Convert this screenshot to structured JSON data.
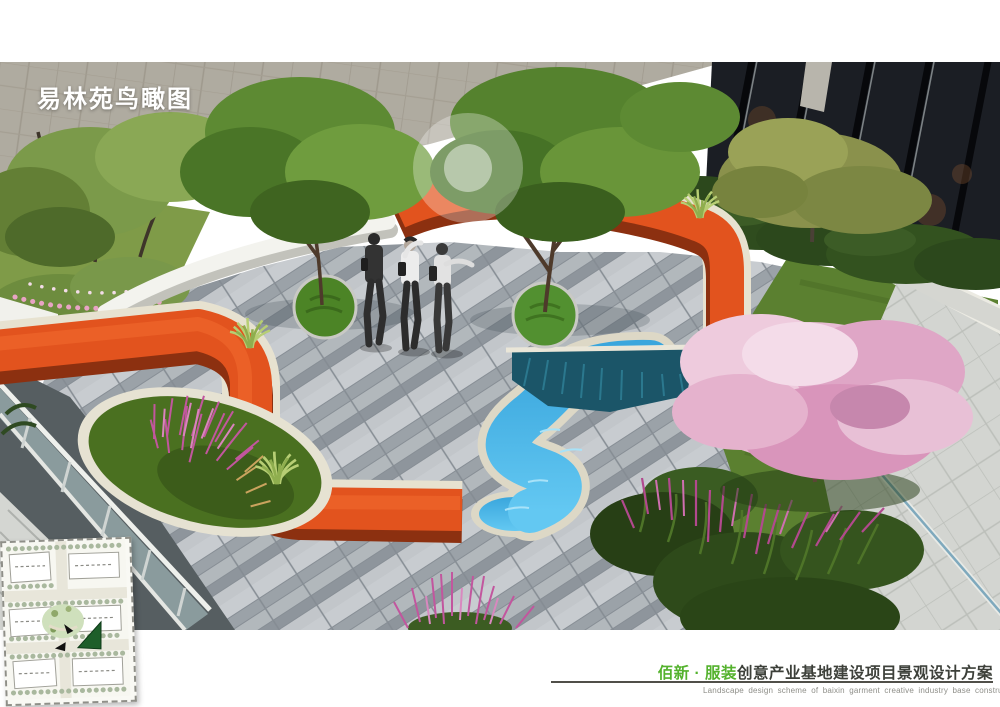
{
  "page": {
    "background_color": "#ffffff",
    "title": "易林苑鸟瞰图",
    "footer": {
      "brand_cn": "佰新 · 服装",
      "project_cn": "创意产业基地建设项目景观设计方案",
      "subtitle_en": "Landscape design scheme of baixin garment creative industry base construction project",
      "brand_color": "#54b22d",
      "project_color": "#3d403a",
      "subtitle_color": "#8e8e88",
      "rule_color": "#504f49"
    }
  },
  "scene": {
    "type": "aerial-landscape-render",
    "elements": [
      "stone-clad-wall",
      "glass-building-facade",
      "tree-canopies",
      "white-curved-bench",
      "orange-ribbon-bench",
      "s-curve-water-channel",
      "plaza-paving",
      "circular-tree-planters",
      "pedestrians",
      "cherry-blossom-tree",
      "ornamental-grass-beds",
      "glass-railing-ramp",
      "lawn"
    ],
    "pedestrian_count": 3,
    "colors": {
      "ribbon_orange": "#e2531e",
      "ribbon_shadow": "#8c3010",
      "water_blue": "#49b6e7",
      "water_dark": "#1b5568",
      "paving_light": "#c8ccd0",
      "paving_dark": "#8e959c",
      "stone_rim": "#e6e2d2",
      "lawn_green": "#5b8030",
      "canopy_green": "#5d8a33",
      "hedge_dark": "#2c481c",
      "blossom_pink": "#e5b2cd",
      "plume_magenta": "#c2569e",
      "wall_gray": "#b6b2a6",
      "glass_dark": "#1b1e24"
    }
  },
  "inset_plan": {
    "type": "site-key-plan",
    "building_count": 6,
    "marker_color": "#1e5e2a"
  }
}
